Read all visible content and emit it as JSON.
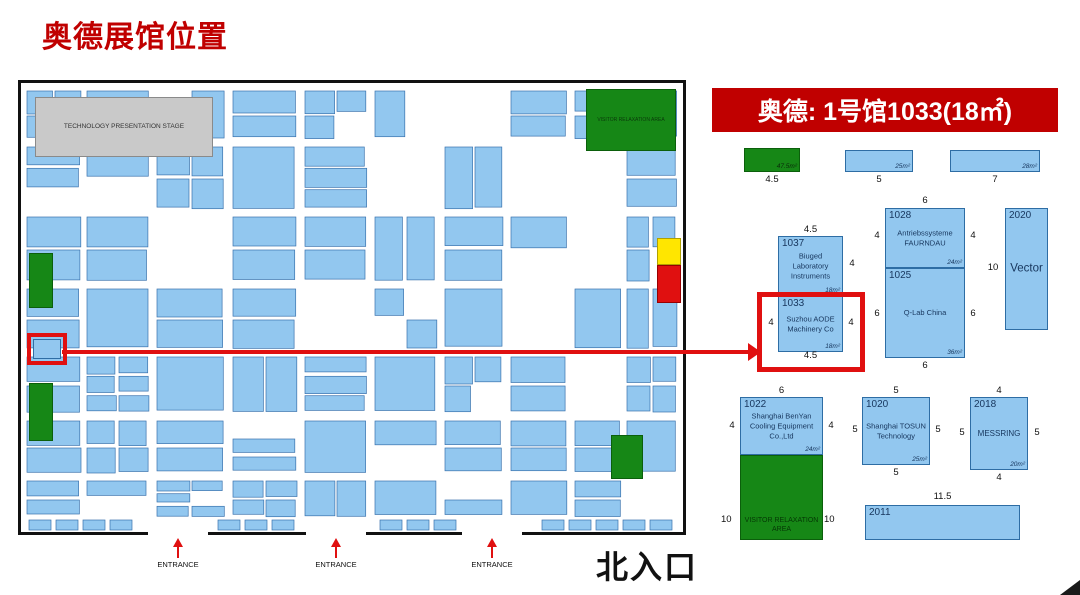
{
  "title": "奥德展馆位置",
  "map": {
    "stage_label": "TECHNOLOGY PRESENTATION STAGE",
    "relaxation_area_label": "VISITOR RELAXATION AREA",
    "entrances": [
      "ENTRANCE",
      "ENTRANCE",
      "ENTRANCE"
    ],
    "north_entrance_label": "北入口",
    "painter": {
      "seed": 12,
      "fill": "#92c7ef",
      "stroke": "#3a72ad"
    }
  },
  "detail": {
    "header": "奥德: 1号馆1033(18㎡)",
    "top_row": {
      "green": {
        "width_label": "4.5",
        "area": "47.5m²"
      },
      "bar1": {
        "width_label": "5",
        "area": "25m²"
      },
      "bar2": {
        "width_label": "7",
        "area": "28m²"
      }
    },
    "booths": {
      "b1037": {
        "id": "1037",
        "name": "Biuged Laboratory Instruments",
        "area": "18m²",
        "top": "4.5",
        "right": "4"
      },
      "b1033": {
        "id": "1033",
        "name": "Suzhou AODE Machinery Co",
        "area": "18m²",
        "left": "4",
        "right": "4",
        "bottom": "4.5"
      },
      "b1028": {
        "id": "1028",
        "name": "Antriebssysteme FAURNDAU",
        "area": "24m²",
        "top": "6",
        "left": "4",
        "right": "4"
      },
      "b1025": {
        "id": "1025",
        "name": "Q-Lab China",
        "area": "36m²",
        "left": "6",
        "right": "6",
        "bottom": "6"
      },
      "b2020": {
        "id": "2020",
        "name": "Vector",
        "left": "10"
      },
      "b1022": {
        "id": "1022",
        "name": "Shanghai BenYan Cooling Equipment Co.,Ltd",
        "area": "24m²",
        "top": "6",
        "left": "4",
        "right": "4"
      },
      "visitor": {
        "label": "VISITOR RELAXATION AREA",
        "left": "10",
        "right": "10"
      },
      "b1020": {
        "id": "1020",
        "name": "Shanghai TOSUN Technology",
        "area": "25m²",
        "top": "5",
        "left": "5",
        "right": "5",
        "bottom": "5"
      },
      "b2018": {
        "id": "2018",
        "name": "MESSRING",
        "area": "20m²",
        "top": "4",
        "left": "5",
        "right": "5",
        "bottom": "4"
      },
      "b2011": {
        "id": "2011",
        "top": "11.5"
      }
    }
  },
  "colors": {
    "accent_red": "#c00000",
    "booth_blue": "#92c7ef",
    "area_green": "#168716",
    "highlight_red": "#e01010",
    "booth_yellow": "#ffe600"
  }
}
